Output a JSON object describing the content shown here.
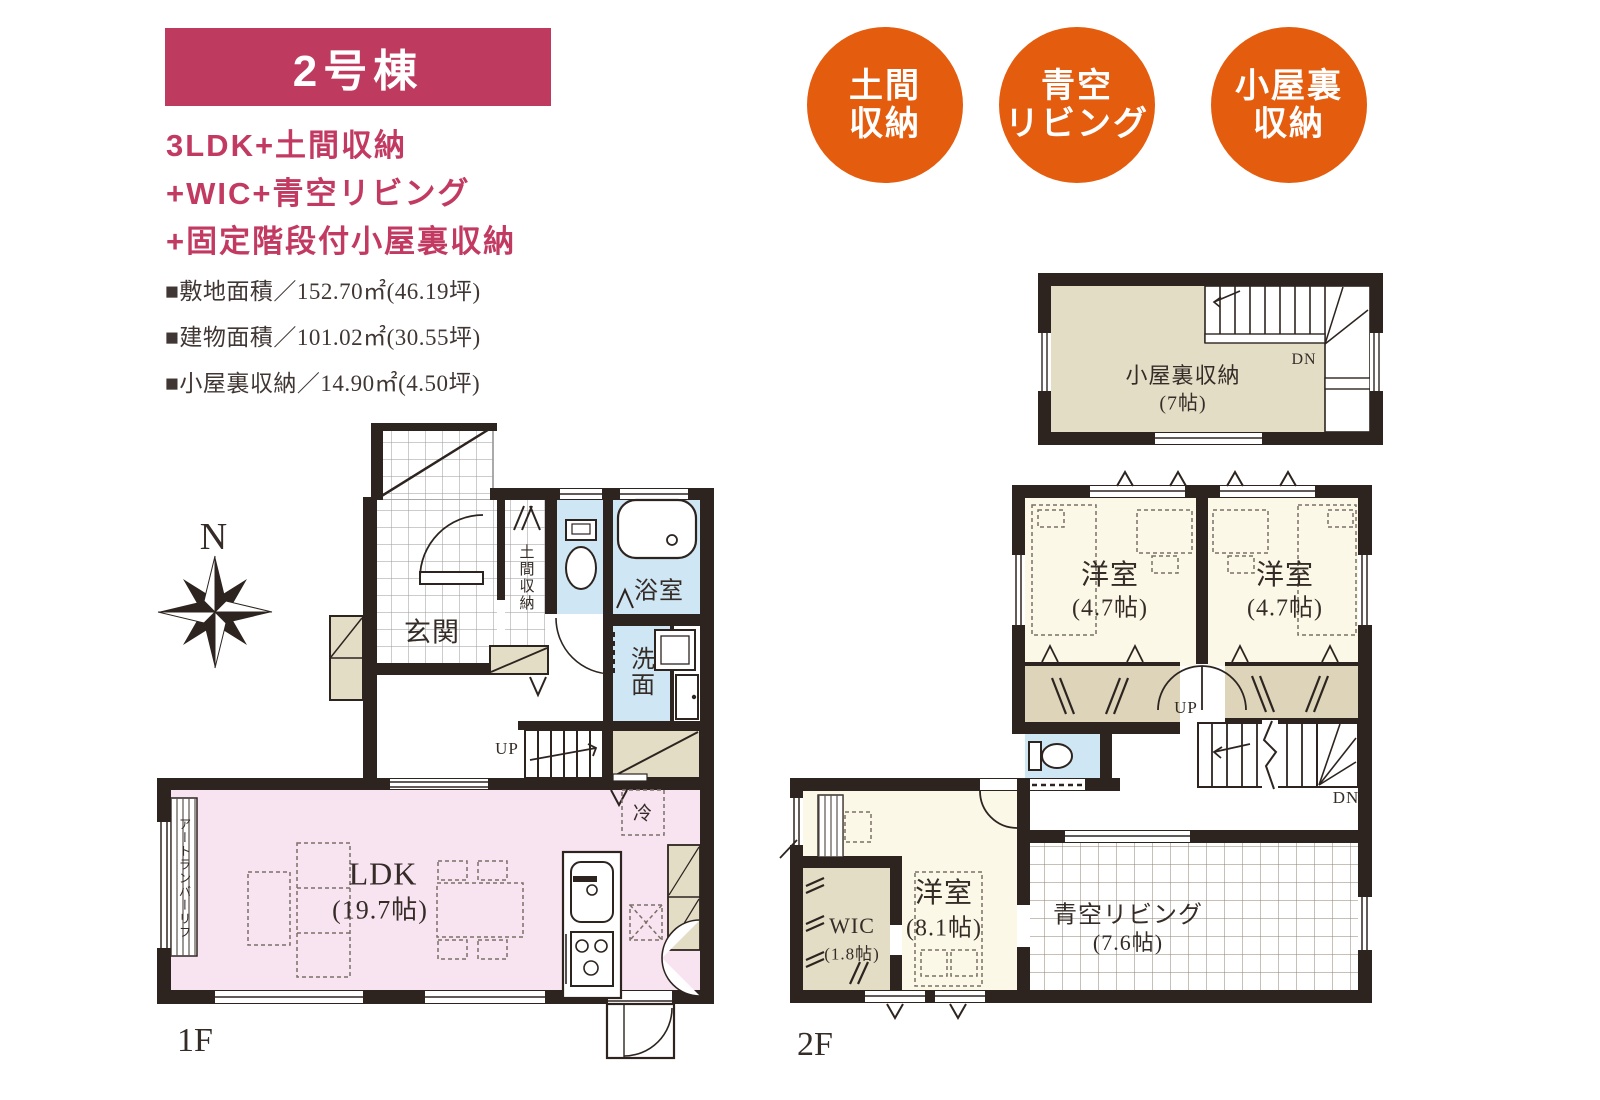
{
  "header": {
    "unit": "2号棟"
  },
  "features": {
    "line1": "3LDK+土間収納",
    "line2": "+WIC+青空リビング",
    "line3": "+固定階段付小屋裏収納"
  },
  "specs": {
    "site": "■敷地面積／152.70㎡(46.19坪)",
    "building": "■建物面積／101.02㎡(30.55坪)",
    "attic": "■小屋裏収納／14.90㎡(4.50坪)"
  },
  "badges": [
    {
      "line1": "土間",
      "line2": "収納"
    },
    {
      "line1": "青空",
      "line2": "リビング"
    },
    {
      "line1": "小屋裏",
      "line2": "収納"
    }
  ],
  "compass": {
    "north": "N"
  },
  "floor1": {
    "label": "1F",
    "ldk": "LDK",
    "ldk_size": "(19.7帖)",
    "genkan": "玄関",
    "doma": "土間収納",
    "bath": "浴室",
    "wash": "洗面",
    "fridge": "冷",
    "up": "UP",
    "deck": "アートランバーリフ"
  },
  "floor2": {
    "label": "2F",
    "bed1": "洋室",
    "bed1_size": "(4.7帖)",
    "bed2": "洋室",
    "bed2_size": "(4.7帖)",
    "bed3": "洋室",
    "bed3_size": "(8.1帖)",
    "wic": "WIC",
    "wic_size": "(1.8帖)",
    "sky": "青空リビング",
    "sky_size": "(7.6帖)",
    "up": "UP",
    "dn": "DN"
  },
  "attic": {
    "name": "小屋裏収納",
    "size": "(7帖)",
    "dn": "DN"
  },
  "icons": {
    "compass": "8-point-star",
    "toilet": "tank-and-bowl",
    "bathtub": "rounded-tub",
    "washer": "square-machine",
    "sink": "rounded-sink",
    "stove": "three-burner"
  },
  "colors": {
    "accent_crimson": "#be3a5f",
    "feature_text": "#c23a62",
    "accent_orange": "#e45c0e",
    "wall": "#2d2420",
    "ldk_pink": "#f8e3f0",
    "wet_blue": "#cfe6f4",
    "room_cream": "#fbf8e8",
    "storage_beige": "#e4ddc6"
  }
}
